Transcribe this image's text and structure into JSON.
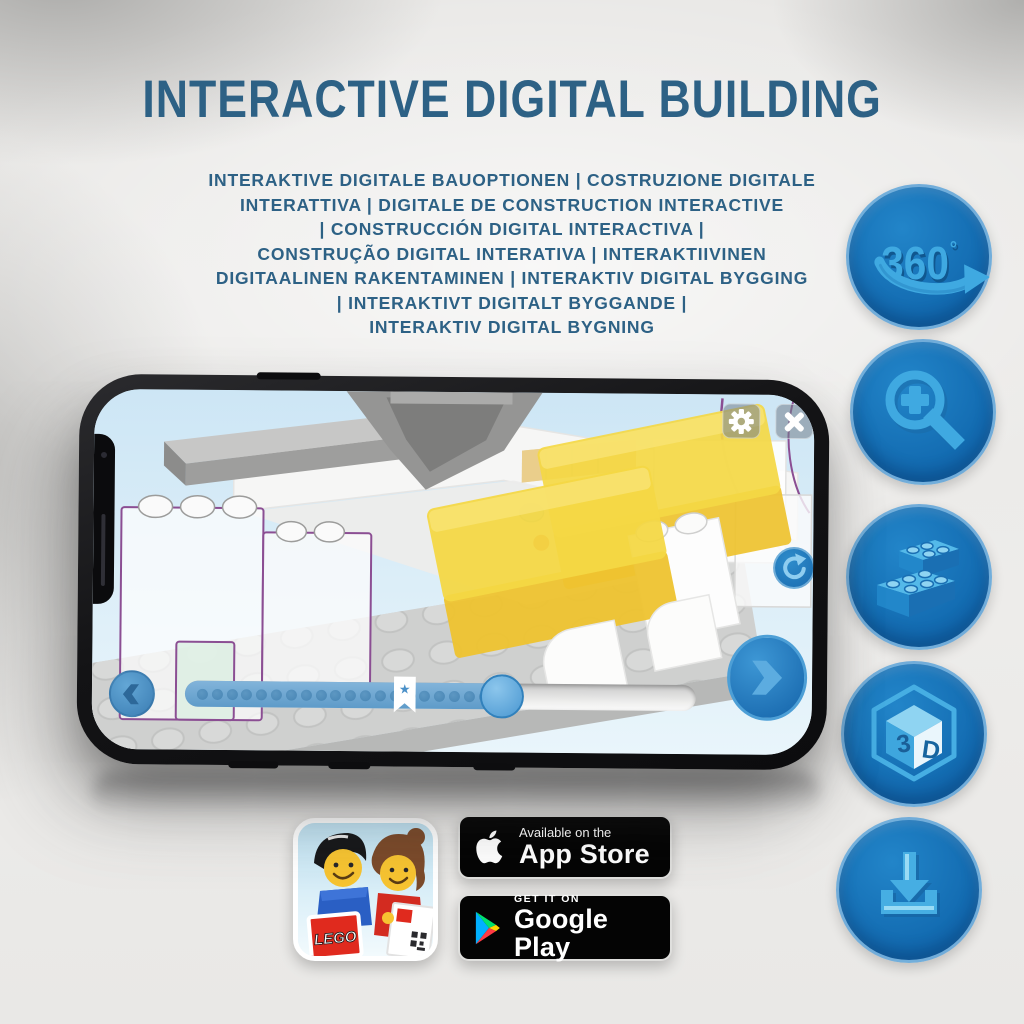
{
  "header": {
    "title": "INTERACTIVE DIGITAL BUILDING",
    "subtitle_lines": [
      "INTERAKTIVE DIGITALE BAUOPTIONEN | COSTRUZIONE DIGITALE",
      "INTERATTIVA | DIGITALE DE CONSTRUCTION INTERACTIVE",
      "| CONSTRUCCIÓN DIGITAL INTERACTIVA |",
      "CONSTRUÇÃO DIGITAL INTERATIVA | INTERAKTIIVINEN",
      "DIGITAALINEN RAKENTAMINEN | INTERAKTIV DIGITAL BYGGING",
      "| INTERAKTIVT DIGITALT BYGGANDE |",
      "INTERAKTIV DIGITAL BYGNING"
    ]
  },
  "feature_icons": {
    "rotate360": {
      "label": "360",
      "degree": "°",
      "icon": "360-swoosh-arrow"
    },
    "zoom": {
      "icon": "magnifier-plus"
    },
    "bricks": {
      "icon": "two-lego-bricks"
    },
    "cube3d": {
      "icon": "3d-cube",
      "letter1": "3",
      "letter2": "D"
    },
    "download": {
      "icon": "download-tray-arrow"
    }
  },
  "phone_app": {
    "toolbar": {
      "settings_icon": "gear",
      "close_icon": "x"
    },
    "nav": {
      "back_icon": "chevron-left",
      "next_icon": "chevron-right",
      "rotate_icon": "rotate-arrow"
    },
    "progress": {
      "filled_percent": 62,
      "marker_percent": 43,
      "dot_count": 20,
      "marker_glyph": "★"
    }
  },
  "store_badges": {
    "app_store": {
      "line1": "Available on the",
      "line2": "App Store",
      "icon": "apple-logo"
    },
    "google_play": {
      "line1": "GET IT ON",
      "line2": "Google Play",
      "icon": "play-triangle"
    }
  },
  "app_icon": {
    "lego_logo_text": "LEGO"
  },
  "colors": {
    "headline_blue": "#2d6185",
    "circle_blue": "#1572b9",
    "icon_light_blue": "#3fa9e1",
    "app_button_blue": "#1b76bf",
    "screen_sky": "#d7ebf7",
    "brick_yellow": "#f2d33c",
    "ghost_outline_purple": "#8b4e93",
    "badge_black": "#040404"
  }
}
